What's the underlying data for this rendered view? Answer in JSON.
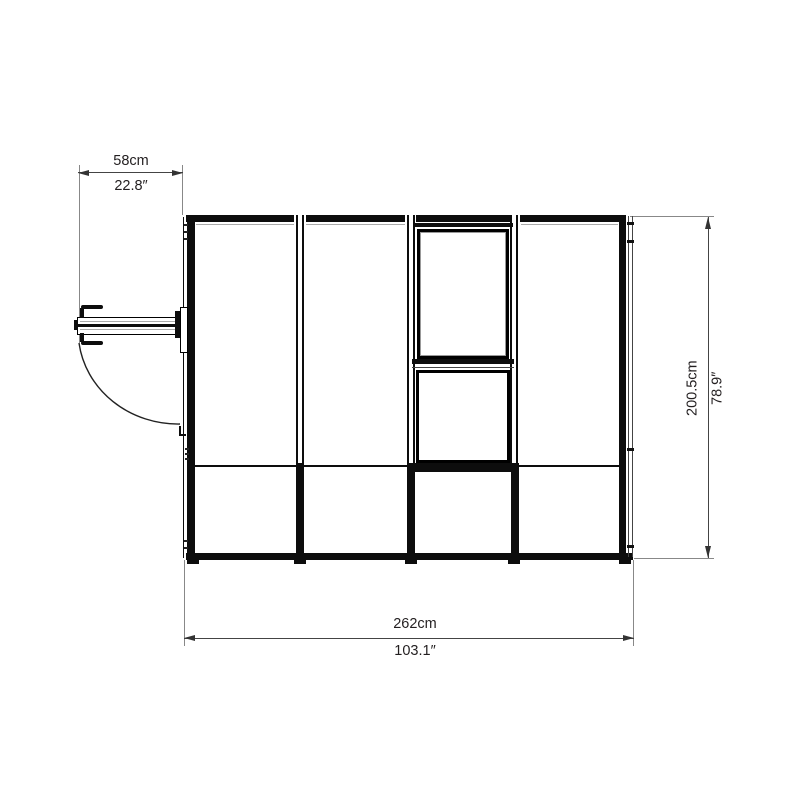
{
  "dimensions": {
    "door_width": {
      "cm": "58cm",
      "inch": "22.8″"
    },
    "height": {
      "cm": "200.5cm",
      "inch": "78.9″"
    },
    "width": {
      "cm": "262cm",
      "inch": "103.1″"
    }
  },
  "colors": {
    "structure_line": "#0d0d0d",
    "dimension_line": "#444444",
    "extension_line": "#888888",
    "text": "#231f20",
    "background": "#ffffff"
  }
}
